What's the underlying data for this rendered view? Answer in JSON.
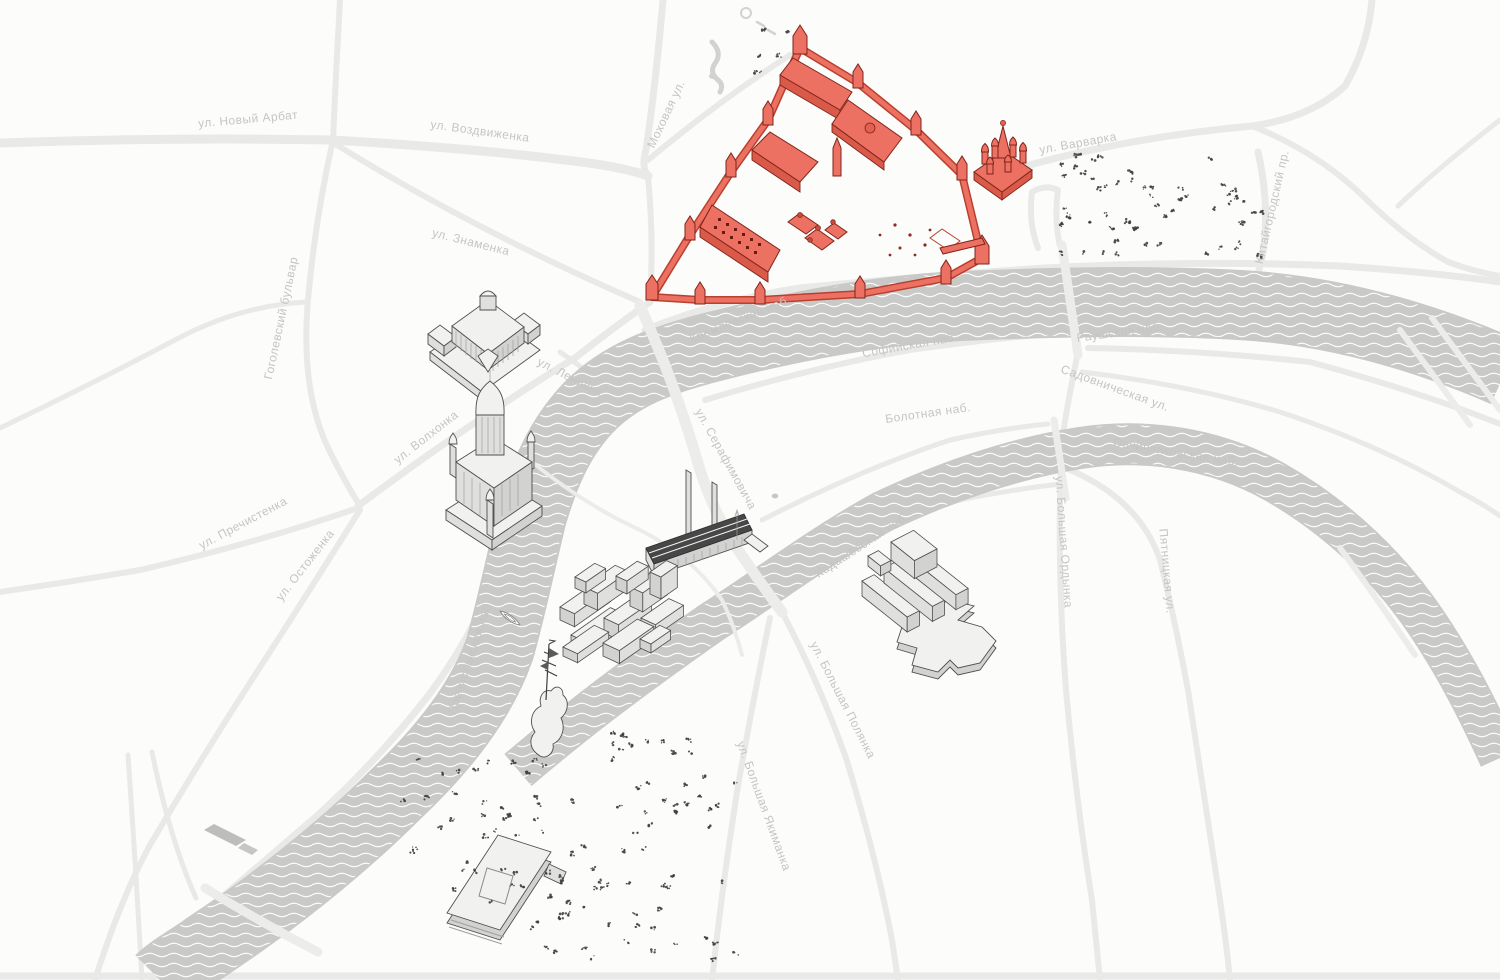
{
  "canvas": {
    "width": 1500,
    "height": 980
  },
  "palette": {
    "land": "#fcfcfb",
    "road": "#e9e9e8",
    "road_light": "#efefee",
    "bridge": "#ececeb",
    "water": "#c9c9c8",
    "wave": "#ffffff",
    "garden": "#d2d2d0",
    "label": "#c5c5c4",
    "red_fill": "#ED7162",
    "red_side": "#D95A49",
    "red_wall": "#B8402F",
    "red_stroke": "#7F241B",
    "gray_top": "#f1f1f0",
    "gray_left": "#dfdfde",
    "gray_right": "#d2d2d1",
    "gray_stroke": "#4f4f4f",
    "roof_dark": "#474747",
    "tree": "#3f3f3f",
    "boat_stroke": "#8a8a8a"
  },
  "street_labels": [
    {
      "text": "ул. Новый Арбат",
      "x": 248,
      "y": 119,
      "rotate": -5
    },
    {
      "text": "ул. Воздвиженка",
      "x": 480,
      "y": 131,
      "rotate": 8
    },
    {
      "text": "Моховая ул.",
      "x": 666,
      "y": 114,
      "rotate": -65
    },
    {
      "text": "ул. Знаменка",
      "x": 471,
      "y": 242,
      "rotate": 14
    },
    {
      "text": "Гоголевский бульвар",
      "x": 281,
      "y": 318,
      "rotate": -78
    },
    {
      "text": "ул. Варварка",
      "x": 1078,
      "y": 143,
      "rotate": -10
    },
    {
      "text": "Китайгородский пр.",
      "x": 1272,
      "y": 207,
      "rotate": -77
    },
    {
      "text": "ул. Ленивка",
      "x": 570,
      "y": 377,
      "rotate": 27
    },
    {
      "text": "ул. Волхонка",
      "x": 426,
      "y": 437,
      "rotate": -38
    },
    {
      "text": "ул. Пречистенка",
      "x": 243,
      "y": 523,
      "rotate": -28
    },
    {
      "text": "ул. Остоженка",
      "x": 305,
      "y": 565,
      "rotate": -52
    },
    {
      "text": "Пречистенская наб.",
      "x": 470,
      "y": 657,
      "rotate": -72
    },
    {
      "text": "Кремлёвская наб.",
      "x": 740,
      "y": 319,
      "rotate": -22
    },
    {
      "text": "Софийская наб.",
      "x": 910,
      "y": 345,
      "rotate": -10
    },
    {
      "text": "Болотная наб.",
      "x": 928,
      "y": 413,
      "rotate": -8
    },
    {
      "text": "Раушская наб.",
      "x": 1120,
      "y": 332,
      "rotate": -8
    },
    {
      "text": "Садовническая ул.",
      "x": 1115,
      "y": 388,
      "rotate": 20
    },
    {
      "text": "Овчинниковская наб.",
      "x": 1176,
      "y": 452,
      "rotate": 9
    },
    {
      "text": "ул. Серафимовича",
      "x": 726,
      "y": 459,
      "rotate": 61
    },
    {
      "text": "Кадашёвская наб.",
      "x": 862,
      "y": 545,
      "rotate": -33
    },
    {
      "text": "ул. Большая Ордынка",
      "x": 1064,
      "y": 542,
      "rotate": 86
    },
    {
      "text": "Пятницкая ул.",
      "x": 1167,
      "y": 571,
      "rotate": 85
    },
    {
      "text": "ул. Большая Полянка",
      "x": 843,
      "y": 700,
      "rotate": 63
    },
    {
      "text": "ул. Большая Якиманка",
      "x": 764,
      "y": 806,
      "rotate": 70
    }
  ],
  "landmarks": [
    {
      "id": "kremlin-complex",
      "highlighted": true
    },
    {
      "id": "st-basils-cathedral",
      "highlighted": true
    },
    {
      "id": "pashkov-house",
      "highlighted": false
    },
    {
      "id": "cathedral-of-christ-the-saviour",
      "highlighted": false
    },
    {
      "id": "ges2-power-station",
      "highlighted": false
    },
    {
      "id": "red-october-blocks",
      "highlighted": false
    },
    {
      "id": "peter-the-great-monument",
      "highlighted": false
    },
    {
      "id": "house-on-embankment",
      "highlighted": false
    },
    {
      "id": "new-tretyakov-gallery",
      "highlighted": false
    }
  ],
  "tree_clusters": [
    {
      "x": 1058,
      "y": 152,
      "w": 205,
      "h": 106,
      "n": 58
    },
    {
      "x": 752,
      "y": 26,
      "w": 44,
      "h": 52,
      "n": 6
    },
    {
      "x": 600,
      "y": 726,
      "w": 100,
      "h": 36,
      "n": 12
    },
    {
      "x": 395,
      "y": 755,
      "w": 150,
      "h": 105,
      "n": 24
    },
    {
      "x": 452,
      "y": 798,
      "w": 215,
      "h": 132,
      "n": 34
    },
    {
      "x": 545,
      "y": 872,
      "w": 195,
      "h": 88,
      "n": 24
    },
    {
      "x": 608,
      "y": 756,
      "w": 128,
      "h": 72,
      "n": 15
    }
  ],
  "boats": [
    {
      "x": 510,
      "y": 618,
      "rotate": -55
    }
  ]
}
